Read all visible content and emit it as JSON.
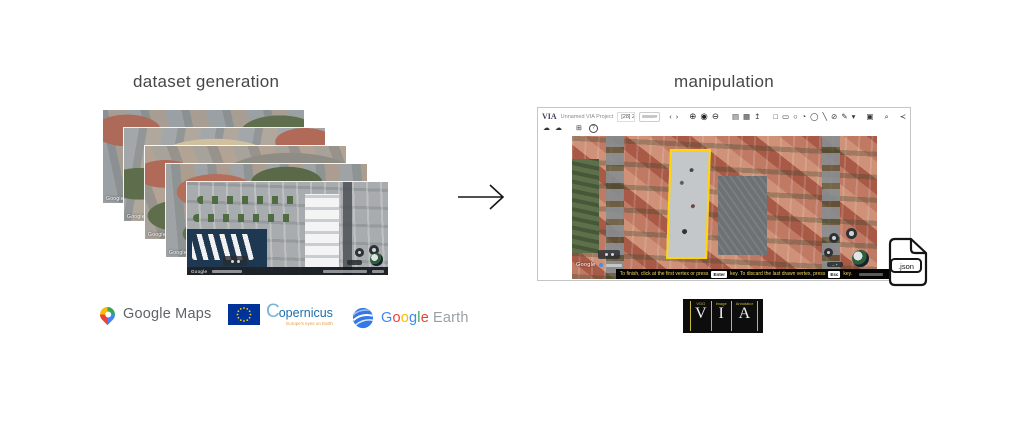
{
  "left": {
    "title": "dataset generation",
    "stack": {
      "watermark": "Google"
    },
    "logos": {
      "google_maps": {
        "label": "Google Maps"
      },
      "copernicus": {
        "name_initial": "C",
        "name_rest": "opernicus",
        "tagline": "Europe's eyes on Earth"
      },
      "google_earth": {
        "google_letters": [
          "G",
          "o",
          "o",
          "g",
          "l",
          "e"
        ],
        "earth": "Earth"
      }
    }
  },
  "right": {
    "title": "manipulation",
    "via": {
      "brand": "VIA",
      "project_name": "Unnamed VIA Project",
      "file_name": "[28] 2C.PNG",
      "toolbar": [
        {
          "name": "prev-image",
          "glyph": "‹"
        },
        {
          "name": "next-image",
          "glyph": "›"
        },
        {
          "name": "zoom-in",
          "glyph": "⊕"
        },
        {
          "name": "actual-size",
          "glyph": "◉"
        },
        {
          "name": "zoom-out",
          "glyph": "⊖"
        },
        {
          "name": "open-project",
          "glyph": "▤"
        },
        {
          "name": "save-project",
          "glyph": "▦"
        },
        {
          "name": "import-export",
          "glyph": "↥"
        },
        {
          "name": "rect-shape",
          "glyph": "□"
        },
        {
          "name": "extreme-rect-shape",
          "glyph": "▭"
        },
        {
          "name": "circle-shape",
          "glyph": "○"
        },
        {
          "name": "extreme-circle-shape",
          "glyph": "◔"
        },
        {
          "name": "ellipse-shape",
          "glyph": "◯"
        },
        {
          "name": "line-shape",
          "glyph": "╲"
        },
        {
          "name": "polygon-shape",
          "glyph": "⊘"
        },
        {
          "name": "polyline-shape",
          "glyph": "✎"
        },
        {
          "name": "more-shapes",
          "glyph": "▾"
        },
        {
          "name": "settings",
          "glyph": "▣"
        },
        {
          "name": "image-grid-zoom",
          "glyph": "⌕"
        },
        {
          "name": "share",
          "glyph": "≺"
        }
      ],
      "toolbar2": [
        {
          "name": "cloud-download",
          "glyph": "☁"
        },
        {
          "name": "cloud-upload",
          "glyph": "☁"
        },
        {
          "name": "window-panel",
          "glyph": "⊞"
        },
        {
          "name": "help",
          "glyph": "?"
        }
      ],
      "dropdown_caret": "▾",
      "map": {
        "watermark": "Google",
        "zoom_control": "‒ +"
      },
      "status": {
        "part1": "To finish, click at the first vertex or press",
        "key1": "Enter",
        "part2": "key. To discard the last drawn vertex, press",
        "key2": "Esc",
        "part3": "key."
      }
    },
    "json_file": {
      "label": ".json"
    },
    "via_badge": {
      "cols": [
        {
          "word": "VGG",
          "letter": "V"
        },
        {
          "word": "Image",
          "letter": "I"
        },
        {
          "word": "Annotator",
          "letter": "A"
        }
      ]
    }
  },
  "colors": {
    "annotation_outline": "#ffd60a",
    "status_text": "#f5d75a",
    "via_badge_accent": "#c9b938",
    "eu_flag_blue": "#003399",
    "eu_star_yellow": "#ffcc00",
    "copernicus_blue": "#1c6fae",
    "copernicus_orange": "#e89b3c",
    "google_gray": "#5f6368",
    "google_blue": "#4285F4",
    "google_red": "#EA4335",
    "google_yellow": "#FBBC05",
    "google_green": "#34A853"
  }
}
